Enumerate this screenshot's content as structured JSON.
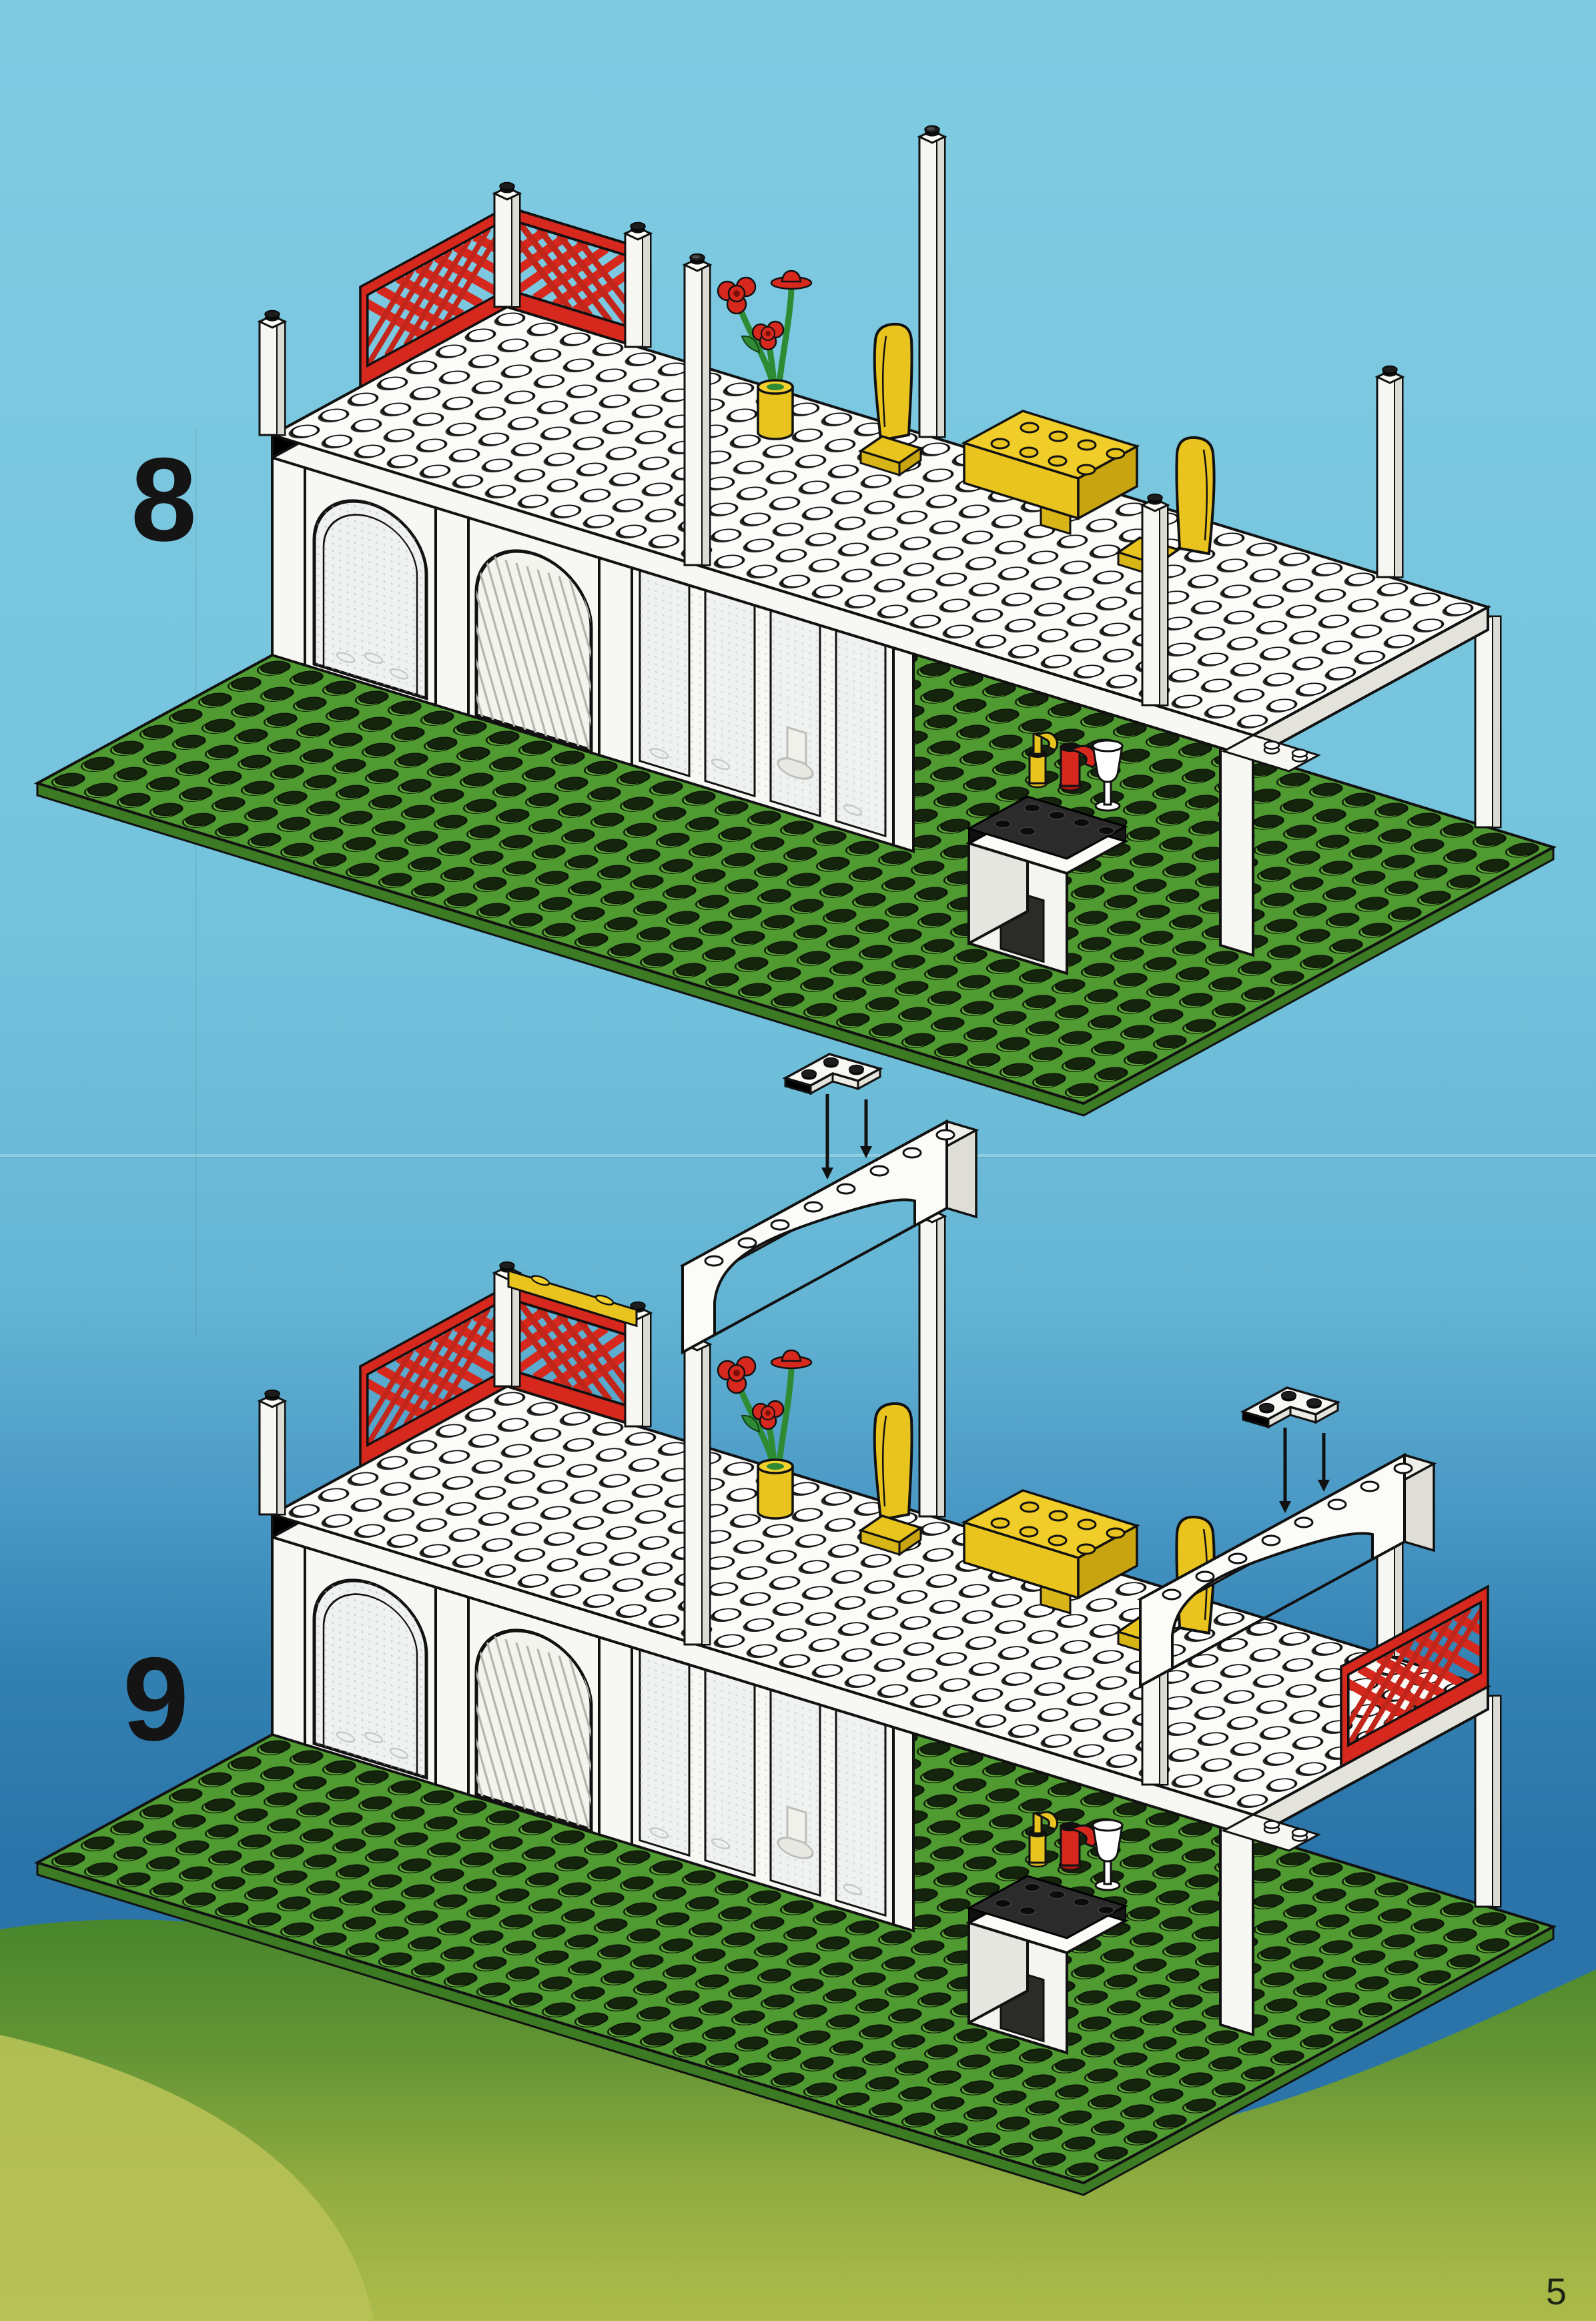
{
  "page": {
    "title": "LEGO building instructions page",
    "page_number": "5"
  },
  "steps": [
    {
      "number": "8"
    },
    {
      "number": "9"
    }
  ],
  "colors": {
    "sky_light": "#7cc9e1",
    "sky_deep": "#2a74a9",
    "hill_green": "#45842b",
    "hill_yellow_green": "#adbc4b",
    "baseplate_green": "#4f9a31",
    "baseplate_edge_green": "#3c7a24",
    "stud_top_dark": "#15240c",
    "stud_side_green": "#61aa3a",
    "brick_white": "#f7f7f3",
    "brick_white_shade": "#dcdcd4",
    "lego_red": "#d7281e",
    "lego_red_dark": "#a81711",
    "lego_yellow": "#e9c41f",
    "lego_yellow_dark": "#c7a410",
    "stem_green": "#2e8b33",
    "glass_tint": "#eff2f0",
    "counter_slab_black": "#1c1c1c",
    "outline_black": "#111111",
    "number_black": "#141414"
  }
}
